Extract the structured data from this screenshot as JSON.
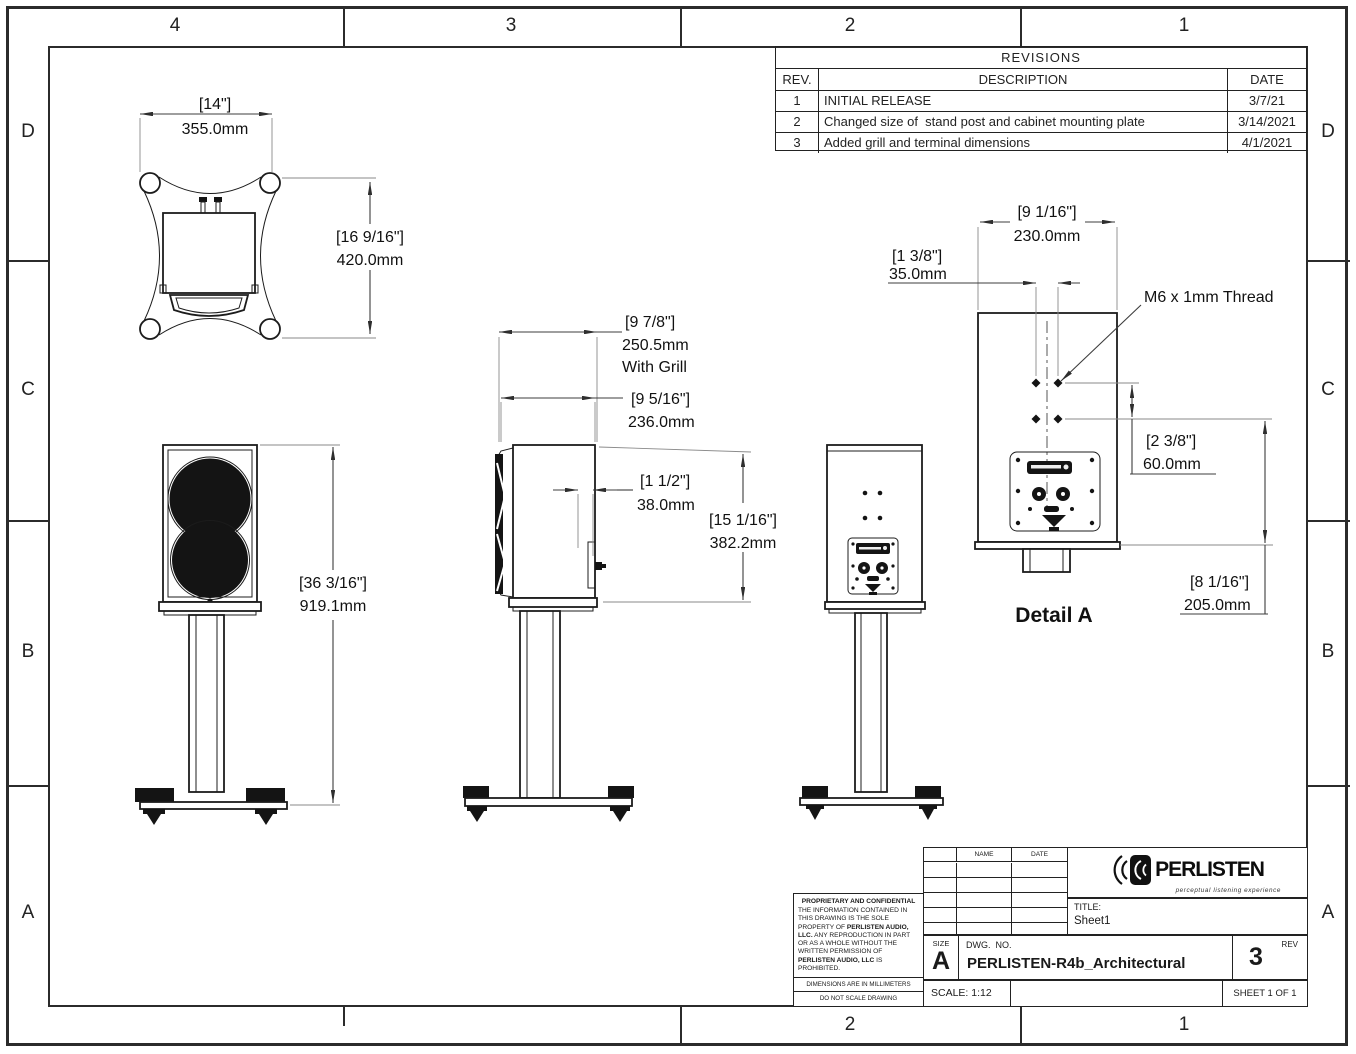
{
  "sheet": {
    "zones": {
      "top": [
        "4",
        "3",
        "2",
        "1"
      ],
      "bottom": [
        "2",
        "1"
      ],
      "left": [
        "D",
        "C",
        "B",
        "A"
      ],
      "right": [
        "D",
        "C",
        "B",
        "A"
      ]
    }
  },
  "revisions": {
    "title": "REVISIONS",
    "headers": {
      "rev": "REV.",
      "description": "DESCRIPTION",
      "date": "DATE"
    },
    "rows": [
      {
        "rev": "1",
        "description": "INITIAL RELEASE",
        "date": "3/7/21"
      },
      {
        "rev": "2",
        "description": "Changed size of  stand post and cabinet mounting plate",
        "date": "3/14/2021"
      },
      {
        "rev": "3",
        "description": "Added grill and terminal dimensions",
        "date": "4/1/2021"
      }
    ]
  },
  "dims": {
    "base_width": {
      "inch": "[14\"]",
      "mm": "355.0mm"
    },
    "base_depth": {
      "inch": "[16 9/16\"]",
      "mm": "420.0mm"
    },
    "overall_height": {
      "inch": "[36 3/16\"]",
      "mm": "919.1mm"
    },
    "depth_with_grill": {
      "inch": "[9 7/8\"]",
      "mm": "250.5mm",
      "note": "With Grill"
    },
    "cabinet_depth": {
      "inch": "[9 5/16\"]",
      "mm": "236.0mm"
    },
    "terminal_depth": {
      "inch": "[1 1/2\"]",
      "mm": "38.0mm"
    },
    "cabinet_height": {
      "inch": "[15 1/16\"]",
      "mm": "382.2mm"
    },
    "cabinet_width": {
      "inch": "[9 1/16\"]",
      "mm": "230.0mm"
    },
    "hole_spacing_h": {
      "inch": "[1 3/8\"]",
      "mm": "35.0mm"
    },
    "hole_spacing_v": {
      "inch": "[2 3/8\"]",
      "mm": "60.0mm"
    },
    "hole_height": {
      "inch": "[8 1/16\"]",
      "mm": "205.0mm"
    }
  },
  "callouts": {
    "thread": "M6 x 1mm Thread",
    "detail_label": "Detail A"
  },
  "title_block": {
    "proprietary": {
      "title": "PROPRIETARY AND CONFIDENTIAL",
      "body_1": "THE INFORMATION CONTAINED IN THIS DRAWING IS THE SOLE PROPERTY OF ",
      "body_bold_1": "PERLISTEN AUDIO, LLC.",
      "body_2": "  ANY REPRODUCTION IN PART OR AS A WHOLE WITHOUT THE WRITTEN PERMISSION OF ",
      "body_bold_2": "PERLISTEN AUDIO, LLC",
      "body_3": " IS PROHIBITED."
    },
    "notes": {
      "units": "DIMENSIONS ARE IN MILLIMETERS",
      "scale_warning": "DO NOT SCALE DRAWING"
    },
    "approval_table": {
      "name": "NAME",
      "date": "DATE"
    },
    "logo": {
      "text": "PERLISTEN",
      "tagline": "perceptual listening experience"
    },
    "title_label": "TITLE:",
    "title_value": "Sheet1",
    "size_label": "SIZE",
    "size_value": "A",
    "dwg_label": "DWG.  NO.",
    "dwg_value": "PERLISTEN-R4b_Architectural",
    "rev_label": "REV",
    "rev_value": "3",
    "scale": "SCALE: 1:12",
    "sheet": "SHEET 1 OF 1"
  }
}
